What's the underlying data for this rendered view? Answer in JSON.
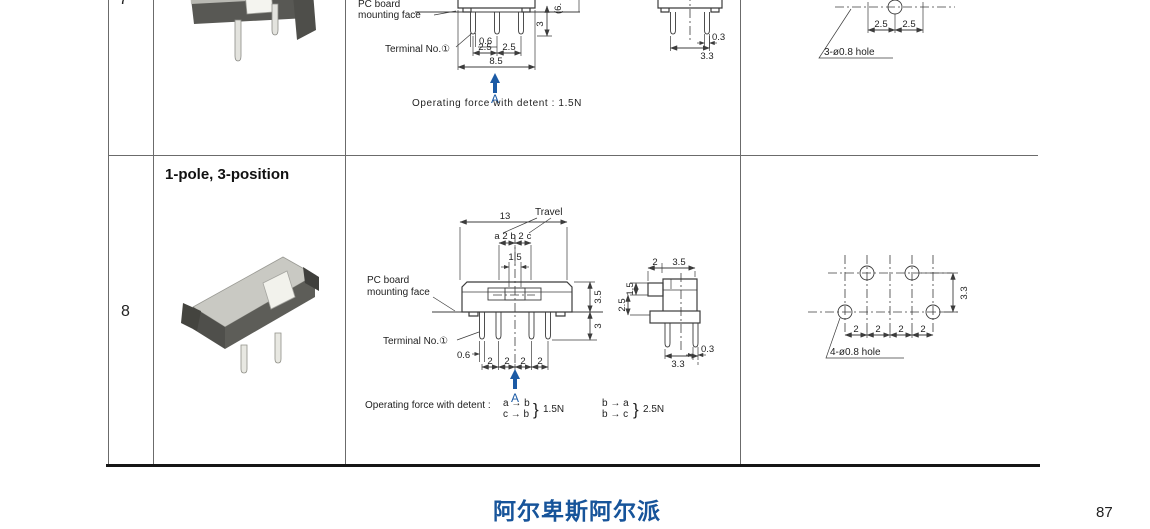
{
  "colors": {
    "accent_blue": "#1b5aa5",
    "drawing_line": "#3c3c3c",
    "table_line": "#6b6b6b",
    "footer_blue": "#17549a"
  },
  "footer": {
    "brand": "阿尔卑斯阿尔派",
    "page_number": "87"
  },
  "row7": {
    "number": "7",
    "front": {
      "pc_board_1": "PC board",
      "pc_board_2": "mounting face",
      "terminal": "Terminal No.①",
      "d06": "0.6",
      "d25l": "2.5",
      "d25r": "2.5",
      "d85": "8.5",
      "d3": "3",
      "d6p": "(6.",
      "pointer": "A",
      "force": "Operating force with detent : 1.5N"
    },
    "side": {
      "d03": "0.3",
      "d33": "3.3"
    },
    "pcb": {
      "d25l": "2.5",
      "d25r": "2.5",
      "hole": "3-ø0.8 hole"
    }
  },
  "row8": {
    "number": "8",
    "type_label": "1-pole, 3-position",
    "front": {
      "d13": "13",
      "travel": "Travel",
      "pa": "a",
      "g1": "2",
      "pb": "b",
      "g2": "2",
      "pc": "c",
      "d15": "1.5",
      "pc_board_1": "PC board",
      "pc_board_2": "mounting  face",
      "terminal": "Terminal  No.①",
      "d06": "0.6",
      "d35": "3.5",
      "d3": "3",
      "p1": "2",
      "p2": "2",
      "p3": "2",
      "p4": "2",
      "pointer": "A",
      "force_label": "Operating  force  with  detent :",
      "f1_top": "a → b",
      "f1_bot": "c → b",
      "brace": "}",
      "f1_val": "1.5N",
      "f2_top": "b → a",
      "f2_bot": "b → c",
      "f2_val": "2.5N"
    },
    "side": {
      "d2": "2",
      "d35": "3.5",
      "d15": "1.5",
      "d25": "2.5",
      "d03": "0.3",
      "d33": "3.3"
    },
    "pcb": {
      "p1": "2",
      "p2": "2",
      "p3": "2",
      "p4": "2",
      "d33": "3.3",
      "hole": "4-ø0.8 hole"
    }
  }
}
